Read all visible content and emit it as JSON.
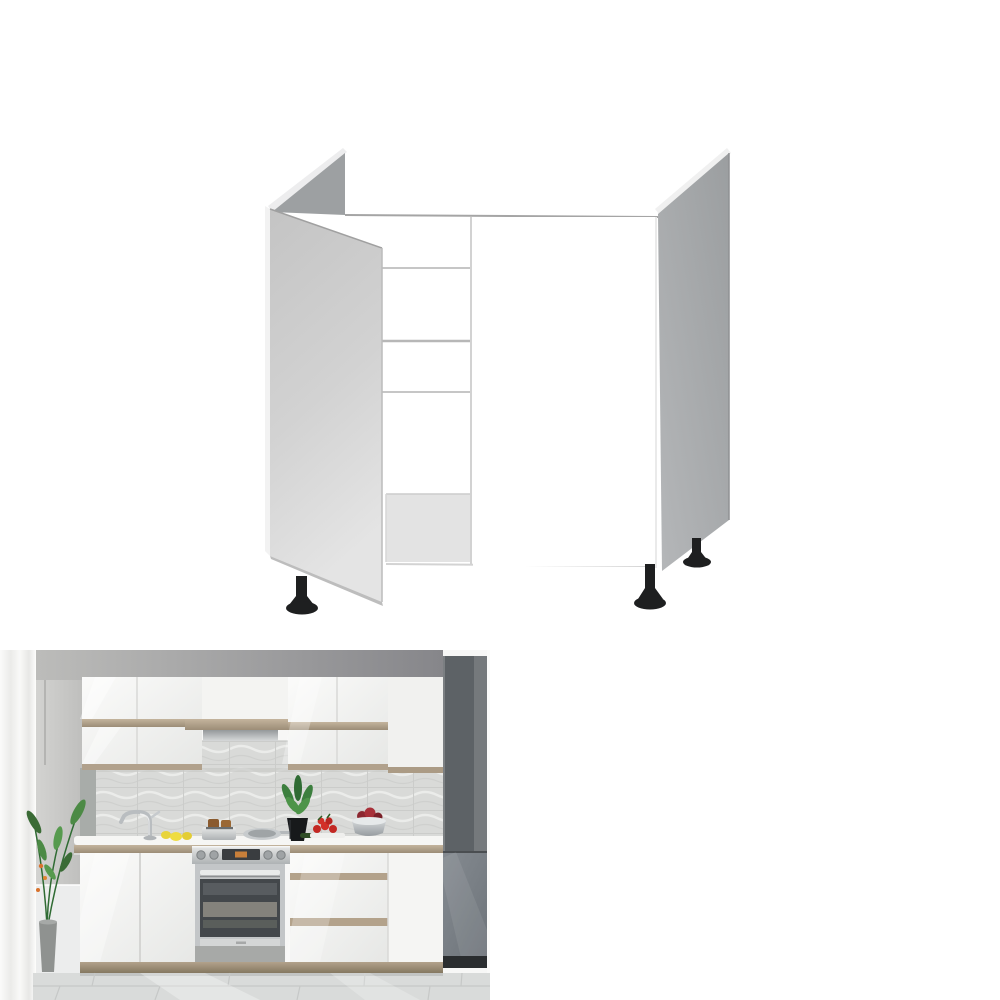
{
  "page": {
    "background": "#ffffff",
    "kind": "product-listing-image-montage"
  },
  "figures": [
    {
      "name": "sink-base-cabinet-render",
      "label": "3D render of a white sink base cabinet with open left door, open top, inner rails and black adjustable legs",
      "colors": {
        "carcass_white": "#ffffff",
        "open_door_grey": "#cfcfcf",
        "side_panel_grey": "#a9acae",
        "inner_shadow_grey": "#9da0a2",
        "rail_line_grey": "#c6c6c6",
        "feet_black": "#1e1f20"
      }
    },
    {
      "name": "kitchen-scene-photo",
      "label": "Modern kitchen photo with white gloss cabinets, oak accent strips, wavy tile backsplash, built-in oven, grey tall unit, plants and fruit on the worktop",
      "colors": {
        "gloss_white": "#f4f4f2",
        "oak_accent": "#b3a28b",
        "wall_grey": "#c9c9c7",
        "tall_unit_grey": "#5d6266",
        "fridge_grey": "#7d838a",
        "tile_grey": "#d9dad8",
        "floor_grey": "#d8dad9",
        "oven_steel": "#c3c6c8",
        "oven_glass": "#43474b",
        "plant_green": "#3c7f3e",
        "lemon_yellow": "#e9d63d",
        "tomato_red": "#c32823"
      }
    }
  ]
}
